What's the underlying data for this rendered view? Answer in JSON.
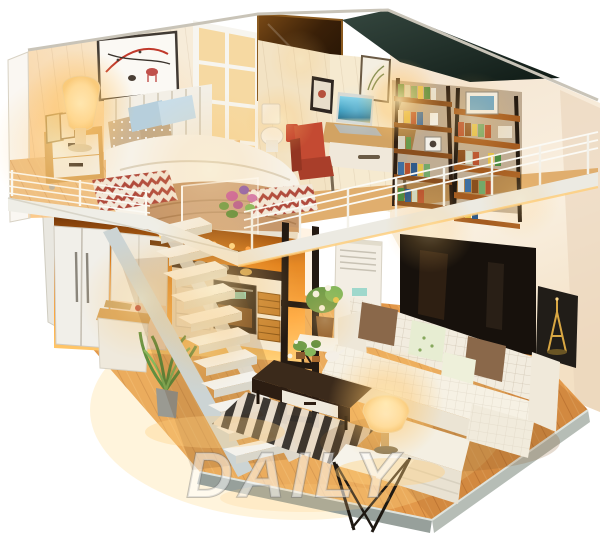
{
  "meta": {
    "type": "photograph",
    "subject": "DIY miniature dollhouse kit — two-story loft apartment room box with warm LED lighting",
    "view": "three-quarter view, open diorama on white background"
  },
  "watermark": {
    "text": "DAILY"
  },
  "palette": {
    "background": "#ffffff",
    "glow_warm": "#ffc268",
    "lamp_light": "#fff3da",
    "floor_wood": "#e2984a",
    "floor_wood_light": "#f3bc72",
    "wall_cream": "#f7e9d4",
    "wall_peach": "#f6e3cc",
    "fascia_white": "#efeee7",
    "railing_white": "#fbfaf5",
    "stair_tread": "#f4f2ec",
    "stair_stringer": "#ccd4d4",
    "base_edge_grey": "#a9aca3",
    "bed_linen": "#f7f2e8",
    "blanket_tan": "#c6976b",
    "pillow_blue": "#b7cfdc",
    "pillow_polka": "#cdb492",
    "rug_red": "#b04a3c",
    "rug_white": "#f2e7d8",
    "sofa_white": "#f2ecdf",
    "pillow_brown": "#8a684a",
    "pillow_floral": "#e7edd2",
    "coffee_table_brown": "#3b2a1b",
    "stripe_rug_dark": "#35302a",
    "stripe_rug_light": "#e9ddcc",
    "oven_black": "#241d16",
    "wicker_orange": "#c5812f",
    "fridge_white": "#f1efe9",
    "partition_black": "#241a12",
    "ac_white": "#f3eee4",
    "tv_black": "#17110c",
    "shelf_dark": "#2f1f12",
    "shelf_wood": "#a55c20",
    "chair_red": "#c44a32",
    "desk_wood": "#d2a363",
    "laptop_screen": "#2c93b8",
    "plant_green": "#6f9c49",
    "flower_pink": "#c95f9d",
    "eiffel_gold": "#d9a743",
    "poster_dark": "#211d18"
  },
  "scene": {
    "upper_level": {
      "bedroom": [
        "wall-art-picture",
        "bedside-lamp",
        "nightstand",
        "photo-frames",
        "double-bed",
        "blue-pillows",
        "polka-dot-pillows",
        "tan-blanket",
        "chevron-rug",
        "wire-railing",
        "acrylic-flower-panel",
        "white-lattice-partition",
        "mirror-panel"
      ],
      "study": [
        "toilet",
        "red-armchair",
        "desk",
        "laptop",
        "desk-lamp",
        "wall-frames",
        "bookshelf-left",
        "bookshelf-right",
        "loft-railing"
      ]
    },
    "lower_level": {
      "kitchen": [
        "refrigerator",
        "tall-cabinet",
        "upper-shelf",
        "oven",
        "wicker-baskets",
        "counter-with-pots",
        "prep-island",
        "floor-plant",
        "white-staircase"
      ],
      "living_room": [
        "black-frame-partition",
        "standing-air-conditioner",
        "flower-side-table",
        "striped-rug",
        "coffee-table",
        "l-shaped-sofa",
        "brown-cushions",
        "floral-cushions",
        "lamp-side-table",
        "glowing-table-lamp",
        "tv-panel",
        "eiffel-tower-poster",
        "wood-plank-floor"
      ]
    }
  }
}
